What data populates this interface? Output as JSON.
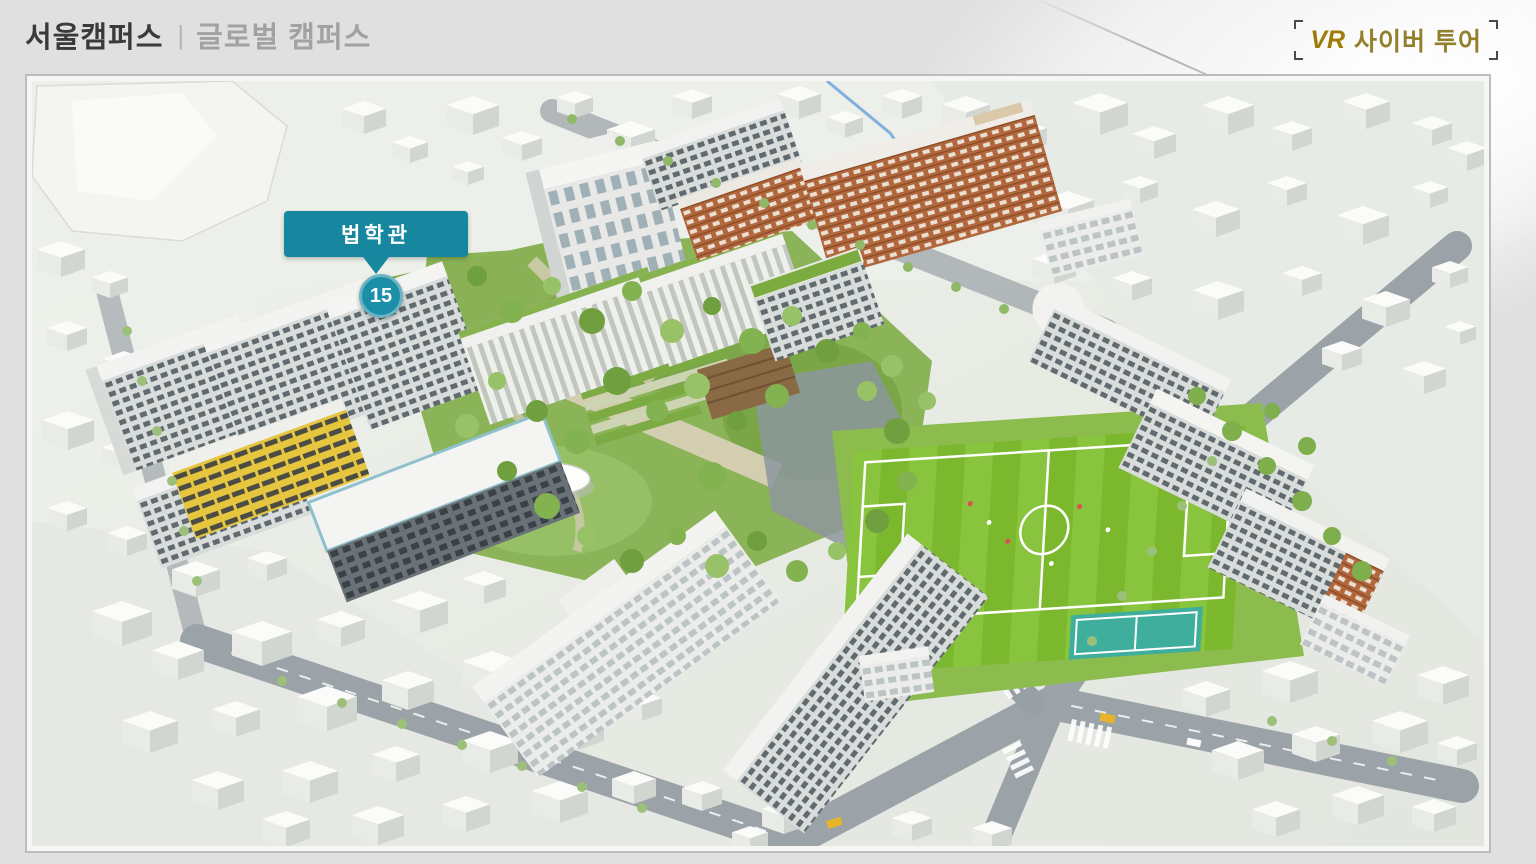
{
  "colors": {
    "accent_teal": "#1787a0",
    "badge_teal": "#1b8fa8",
    "vr_gold": "#9c7b07",
    "page_background": "#e0e0e0"
  },
  "header": {
    "tabs": [
      {
        "id": "seoul",
        "label": "서울캠퍼스",
        "active": true
      },
      {
        "id": "global",
        "label": "글로벌 캠퍼스",
        "active": false
      }
    ],
    "divider": "|",
    "vr_button": {
      "prefix": "VR",
      "label": "사이버 투어"
    }
  },
  "map": {
    "marker": {
      "tooltip": "법학관",
      "number": "15"
    }
  }
}
